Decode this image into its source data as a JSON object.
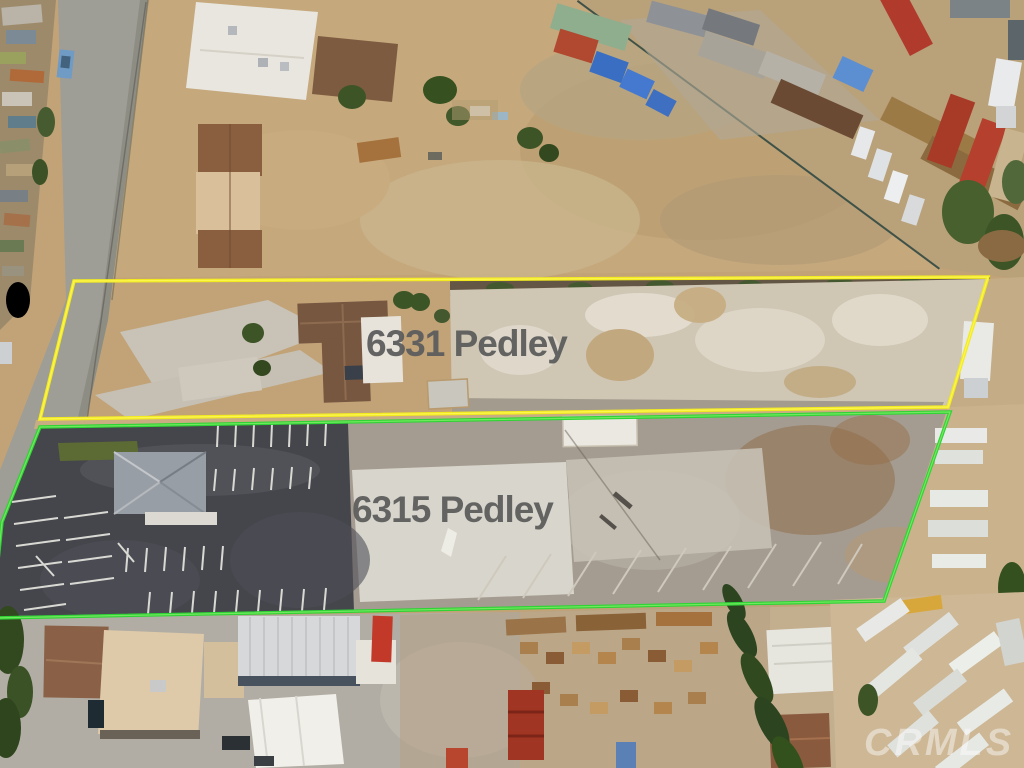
{
  "annotations": {
    "parcels": [
      {
        "address_label": "6331 Pedley",
        "outline_color": "#f2ea1f",
        "outline_highlight": "#fff966"
      },
      {
        "address_label": "6315 Pedley",
        "outline_color": "#2fd335",
        "outline_highlight": "#8bef6e"
      }
    ],
    "label_text_color": "#5d5d5d",
    "watermark_text": "CRMLS"
  }
}
